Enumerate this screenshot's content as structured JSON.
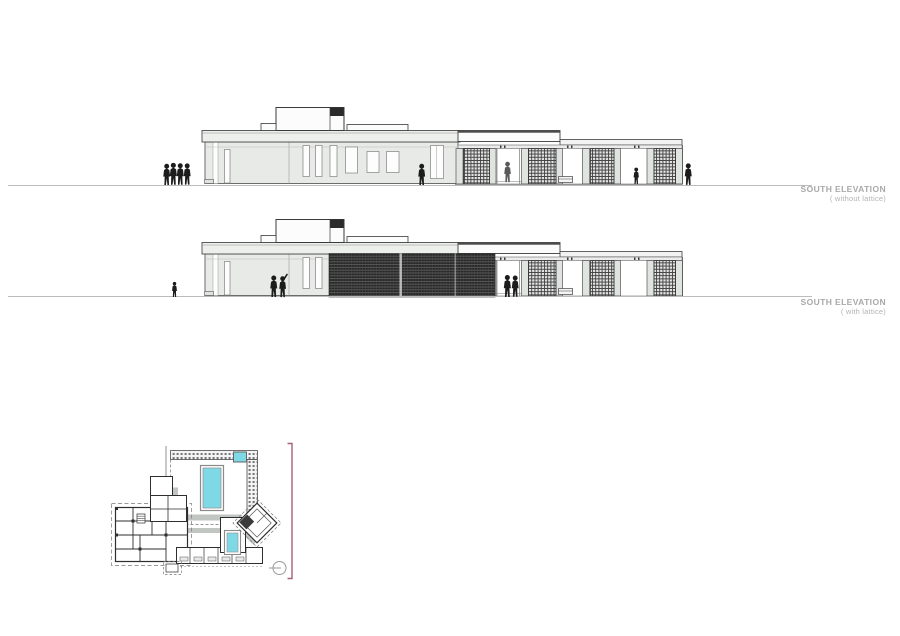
{
  "sheet": {
    "background": "#ffffff"
  },
  "labels": {
    "elevation1": {
      "title": "SOUTH ELEVATION",
      "subtitle": "( without lattice)"
    },
    "elevation2": {
      "title": "SOUTH ELEVATION",
      "subtitle": "( with lattice)"
    }
  },
  "colors": {
    "pool": "#7fd8e6",
    "bracket": "#a4607c",
    "ground_line": "#bbbbbb"
  }
}
